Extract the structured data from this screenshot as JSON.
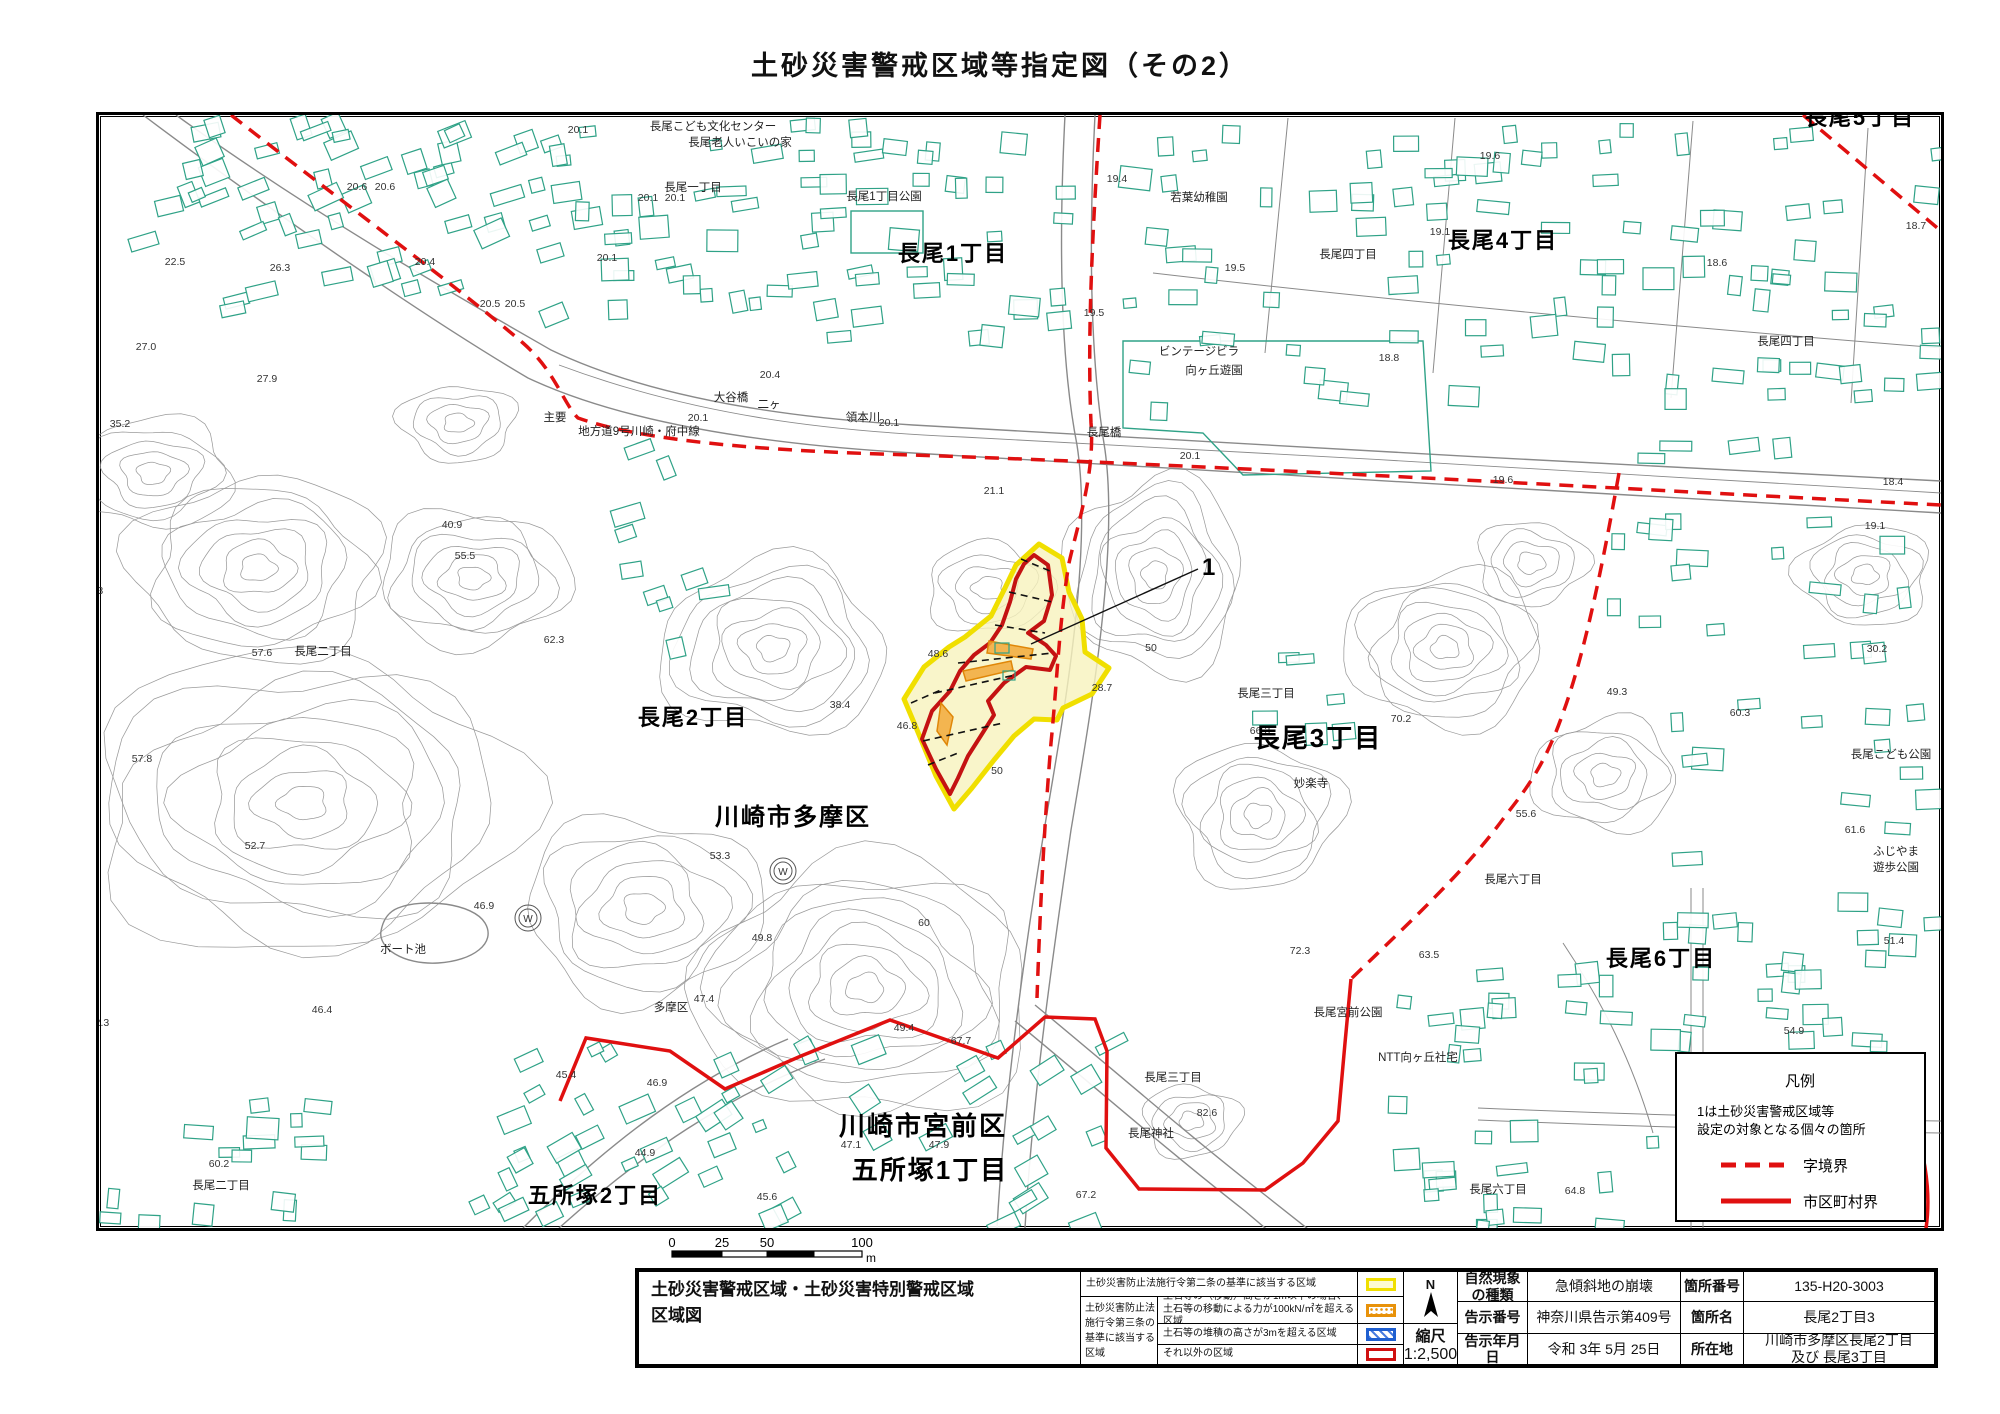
{
  "title": "土砂災害警戒区域等指定図（その2）",
  "map": {
    "marker_label": "1",
    "legend_box": {
      "title": "凡例",
      "note_line1": "1は土砂災害警戒区域等",
      "note_line2": "設定の対象となる個々の箇所",
      "dashed_label": "字境界",
      "solid_label": "市区町村界"
    },
    "scale_bar": {
      "ticks": [
        "0",
        "25",
        "50",
        "100"
      ],
      "unit": "m"
    },
    "large_labels": [
      {
        "t": "長尾1丁目",
        "x": 950,
        "y": 258,
        "s": 22
      },
      {
        "t": "長尾4丁目",
        "x": 1500,
        "y": 245,
        "s": 22
      },
      {
        "t": "長尾5丁目",
        "x": 1857,
        "y": 122,
        "s": 22
      },
      {
        "t": "長尾2丁目",
        "x": 690,
        "y": 722,
        "s": 22
      },
      {
        "t": "川崎市多摩区",
        "x": 790,
        "y": 822,
        "s": 24
      },
      {
        "t": "長尾3丁目",
        "x": 1315,
        "y": 744,
        "s": 26
      },
      {
        "t": "長尾6丁目",
        "x": 1658,
        "y": 963,
        "s": 22
      },
      {
        "t": "川崎市宮前区",
        "x": 920,
        "y": 1132,
        "s": 26
      },
      {
        "t": "五所塚1丁目",
        "x": 927,
        "y": 1176,
        "s": 26
      },
      {
        "t": "五所塚2丁目",
        "x": 592,
        "y": 1200,
        "s": 22
      }
    ],
    "small_labels": [
      {
        "t": "長尾こども文化センター",
        "x": 710,
        "y": 127
      },
      {
        "t": "長尾老人いこいの家",
        "x": 737,
        "y": 143
      },
      {
        "t": "長尾一丁目",
        "x": 690,
        "y": 188
      },
      {
        "t": "長尾1丁目公園",
        "x": 881,
        "y": 197
      },
      {
        "t": "若葉幼稚園",
        "x": 1196,
        "y": 198
      },
      {
        "t": "長尾四丁目",
        "x": 1345,
        "y": 255
      },
      {
        "t": "長尾四丁目",
        "x": 1783,
        "y": 342
      },
      {
        "t": "ビンテージビラ",
        "x": 1196,
        "y": 352
      },
      {
        "t": "向ヶ丘遊園",
        "x": 1211,
        "y": 371
      },
      {
        "t": "大谷橋",
        "x": 728,
        "y": 398
      },
      {
        "t": "二ヶ",
        "x": 766,
        "y": 405
      },
      {
        "t": "領本川",
        "x": 860,
        "y": 418
      },
      {
        "t": "主要",
        "x": 552,
        "y": 418
      },
      {
        "t": "地方道9号川崎・府中線",
        "x": 636,
        "y": 432
      },
      {
        "t": "長尾橋",
        "x": 1101,
        "y": 433
      },
      {
        "t": "長尾二丁目",
        "x": 320,
        "y": 652
      },
      {
        "t": "長尾三丁目",
        "x": 1263,
        "y": 694
      },
      {
        "t": "妙楽寺",
        "x": 1308,
        "y": 784
      },
      {
        "t": "ボート池",
        "x": 400,
        "y": 950
      },
      {
        "t": "多摩区",
        "x": 668,
        "y": 1008
      },
      {
        "t": "長尾六丁目",
        "x": 1510,
        "y": 880
      },
      {
        "t": "長尾こども公園",
        "x": 1888,
        "y": 755
      },
      {
        "t": "ふじやま",
        "x": 1893,
        "y": 852
      },
      {
        "t": "遊歩公園",
        "x": 1893,
        "y": 868
      },
      {
        "t": "長尾宮前公園",
        "x": 1345,
        "y": 1013
      },
      {
        "t": "NTT向ヶ丘社宅",
        "x": 1415,
        "y": 1058
      },
      {
        "t": "長尾三丁目",
        "x": 1170,
        "y": 1078
      },
      {
        "t": "長尾神社",
        "x": 1148,
        "y": 1134
      },
      {
        "t": "長尾六丁目",
        "x": 1495,
        "y": 1190
      },
      {
        "t": "長尾二丁目",
        "x": 218,
        "y": 1186
      }
    ],
    "spot_heights": [
      {
        "t": "20.1",
        "x": 575,
        "y": 130
      },
      {
        "t": "19.6",
        "x": 1487,
        "y": 156
      },
      {
        "t": "18.7",
        "x": 1913,
        "y": 226
      },
      {
        "t": "19.1",
        "x": 1437,
        "y": 232
      },
      {
        "t": "20.6",
        "x": 354,
        "y": 187
      },
      {
        "t": "20.6",
        "x": 382,
        "y": 187
      },
      {
        "t": "20.1",
        "x": 645,
        "y": 198
      },
      {
        "t": "20.1",
        "x": 672,
        "y": 198
      },
      {
        "t": "22.5",
        "x": 172,
        "y": 262
      },
      {
        "t": "26.3",
        "x": 277,
        "y": 268
      },
      {
        "t": "20.4",
        "x": 422,
        "y": 262
      },
      {
        "t": "20.1",
        "x": 604,
        "y": 258
      },
      {
        "t": "18.6",
        "x": 1714,
        "y": 263
      },
      {
        "t": "19.4",
        "x": 1114,
        "y": 179
      },
      {
        "t": "27.0",
        "x": 143,
        "y": 347
      },
      {
        "t": "27.9",
        "x": 264,
        "y": 379
      },
      {
        "t": "20.5",
        "x": 487,
        "y": 304
      },
      {
        "t": "20.5",
        "x": 512,
        "y": 304
      },
      {
        "t": "19.5",
        "x": 1091,
        "y": 313
      },
      {
        "t": "19.5",
        "x": 1232,
        "y": 268
      },
      {
        "t": "18.8",
        "x": 1386,
        "y": 358
      },
      {
        "t": "35.2",
        "x": 117,
        "y": 424
      },
      {
        "t": "20.4",
        "x": 767,
        "y": 375
      },
      {
        "t": "20.1",
        "x": 695,
        "y": 418
      },
      {
        "t": "20.1",
        "x": 886,
        "y": 423
      },
      {
        "t": "18.4",
        "x": 1890,
        "y": 482
      },
      {
        "t": "21.1",
        "x": 991,
        "y": 491
      },
      {
        "t": "20.1",
        "x": 1187,
        "y": 456
      },
      {
        "t": "19.6",
        "x": 1500,
        "y": 480
      },
      {
        "t": "19.1",
        "x": 1872,
        "y": 526
      },
      {
        "t": "40.9",
        "x": 449,
        "y": 525
      },
      {
        "t": "43.3",
        "x": 90,
        "y": 591
      },
      {
        "t": "55.5",
        "x": 462,
        "y": 556
      },
      {
        "t": "57.6",
        "x": 259,
        "y": 653
      },
      {
        "t": "62.3",
        "x": 551,
        "y": 640
      },
      {
        "t": "30.2",
        "x": 1874,
        "y": 649
      },
      {
        "t": "49.3",
        "x": 1614,
        "y": 692
      },
      {
        "t": "60.3",
        "x": 1737,
        "y": 713
      },
      {
        "t": "38.4",
        "x": 837,
        "y": 705
      },
      {
        "t": "48.6",
        "x": 935,
        "y": 654
      },
      {
        "t": "46.8",
        "x": 904,
        "y": 726
      },
      {
        "t": "50",
        "x": 1148,
        "y": 648
      },
      {
        "t": "28.7",
        "x": 1099,
        "y": 688
      },
      {
        "t": "66.3",
        "x": 1257,
        "y": 731
      },
      {
        "t": "70.2",
        "x": 1398,
        "y": 719
      },
      {
        "t": "50",
        "x": 994,
        "y": 771
      },
      {
        "t": "57.8",
        "x": 139,
        "y": 759
      },
      {
        "t": "52.7",
        "x": 252,
        "y": 846
      },
      {
        "t": "46.9",
        "x": 481,
        "y": 906
      },
      {
        "t": "53.3",
        "x": 717,
        "y": 856
      },
      {
        "t": "49.8",
        "x": 759,
        "y": 938
      },
      {
        "t": "60",
        "x": 921,
        "y": 923
      },
      {
        "t": "47.4",
        "x": 701,
        "y": 999
      },
      {
        "t": "46.4",
        "x": 319,
        "y": 1010
      },
      {
        "t": "52.3",
        "x": 96,
        "y": 1023
      },
      {
        "t": "72.3",
        "x": 1297,
        "y": 951
      },
      {
        "t": "55.6",
        "x": 1523,
        "y": 814
      },
      {
        "t": "63.5",
        "x": 1426,
        "y": 955
      },
      {
        "t": "61.6",
        "x": 1852,
        "y": 830
      },
      {
        "t": "51.4",
        "x": 1891,
        "y": 941
      },
      {
        "t": "54.9",
        "x": 1791,
        "y": 1031
      },
      {
        "t": "49.4",
        "x": 901,
        "y": 1028
      },
      {
        "t": "67.7",
        "x": 958,
        "y": 1041
      },
      {
        "t": "45.4",
        "x": 563,
        "y": 1075
      },
      {
        "t": "46.9",
        "x": 654,
        "y": 1083
      },
      {
        "t": "47.1",
        "x": 848,
        "y": 1145
      },
      {
        "t": "47.9",
        "x": 936,
        "y": 1145
      },
      {
        "t": "45.6",
        "x": 764,
        "y": 1197
      },
      {
        "t": "67.2",
        "x": 1083,
        "y": 1195
      },
      {
        "t": "82.6",
        "x": 1204,
        "y": 1113
      },
      {
        "t": "64.8",
        "x": 1572,
        "y": 1191
      },
      {
        "t": "60.2",
        "x": 216,
        "y": 1164
      },
      {
        "t": "54.2",
        "x": 75,
        "y": 1146
      },
      {
        "t": "44.9",
        "x": 642,
        "y": 1153
      }
    ]
  },
  "bottom_table": {
    "map_title_line1": "土砂災害警戒区域・土砂災害特別警戒区域",
    "map_title_line2": "区域図",
    "legend": {
      "row_article2": "土砂災害防止法施行令第二条の基準に該当する区域",
      "article3_l1": "土砂災害防止法",
      "article3_l2": "施行令第三条の",
      "article3_l3": "基準に該当する",
      "article3_l4": "区域",
      "row_orange_l1": "土石等の（移動）高さが1m以下の場合、",
      "row_orange_l2": "土石等の移動による力が100kN/㎡を超える区域",
      "row_blue": "土石等の堆積の高さが3mを超える区域",
      "row_red": "それ以外の区域"
    },
    "compass_n": "N",
    "scale_label": "縮尺",
    "scale_value": "1:2,500",
    "info": {
      "r1c1a": "自然現象",
      "r1c1b": "の種類",
      "r1c2": "急傾斜地の崩壊",
      "r1c3": "箇所番号",
      "r1c4": "135-H20-3003",
      "r2c1": "告示番号",
      "r2c2": "神奈川県告示第409号",
      "r2c3": "箇所名",
      "r2c4": "長尾2丁目3",
      "r3c1": "告示年月日",
      "r3c2": "令和 3年 5月 25日",
      "r3c3": "所在地",
      "r3c4a": "川崎市多摩区長尾2丁目",
      "r3c4b": "及び 長尾3丁目"
    }
  },
  "colors": {
    "boundary_red": "#e01010",
    "zone_yellow_border": "#f0df00",
    "zone_yellow_fill": "#f8f3bd",
    "zone_red": "#c41212",
    "zone_orange": "#e8920a",
    "building_green": "#2fa287",
    "contour_gray": "#9b9b9b"
  }
}
